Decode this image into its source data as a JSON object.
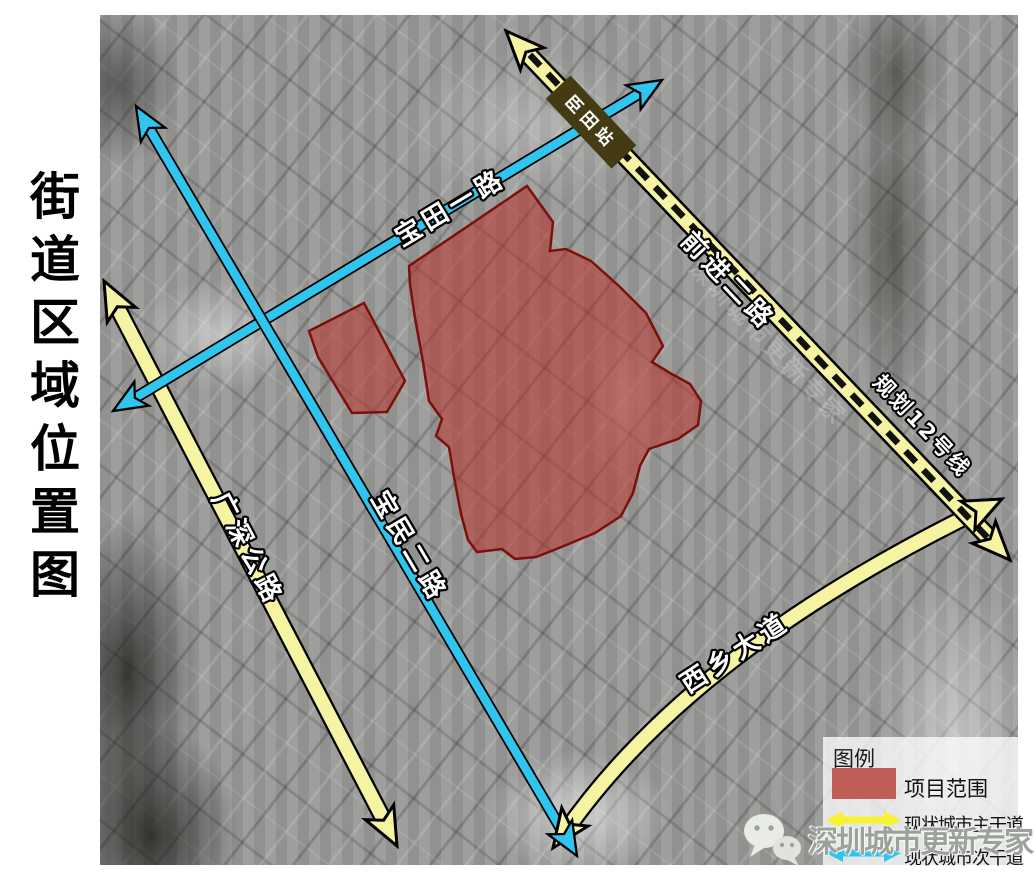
{
  "title": {
    "text": "街道区域位置图"
  },
  "map": {
    "station": {
      "label": "臣田站"
    },
    "roads": {
      "baotian": {
        "label": "宝田一路",
        "type": "existing-secondary"
      },
      "baomin": {
        "label": "宝民二路",
        "type": "existing-secondary"
      },
      "guangshen": {
        "label": "广深公路",
        "type": "existing-primary"
      },
      "xixiang": {
        "label": "西乡大道",
        "type": "existing-primary"
      },
      "qianjin": {
        "label": "前进二路",
        "type": "existing-primary"
      },
      "metro": {
        "label": "规划12号线",
        "type": "planned-metro-line"
      }
    }
  },
  "legend": {
    "title": "图例",
    "items": [
      {
        "label": "项目范围",
        "symbol": "red-area",
        "color": "#bf5f58"
      },
      {
        "label": "现状城市主干道",
        "symbol": "yellow-double-arrow",
        "color": "#f8f332"
      },
      {
        "label": "现状城市次干道",
        "symbol": "cyan-double-arrow",
        "color": "#2fc5ee"
      }
    ]
  },
  "watermark": {
    "text": "深圳城市更新专家",
    "icon": "wechat-icon"
  },
  "colors": {
    "primary_road": "#f6f3a3",
    "secondary_road": "#2fc5ee",
    "project_area_fill": "#b93029",
    "project_area_stroke": "#7c100b",
    "metro_dash": "#111111",
    "station_box": "#453b13"
  }
}
